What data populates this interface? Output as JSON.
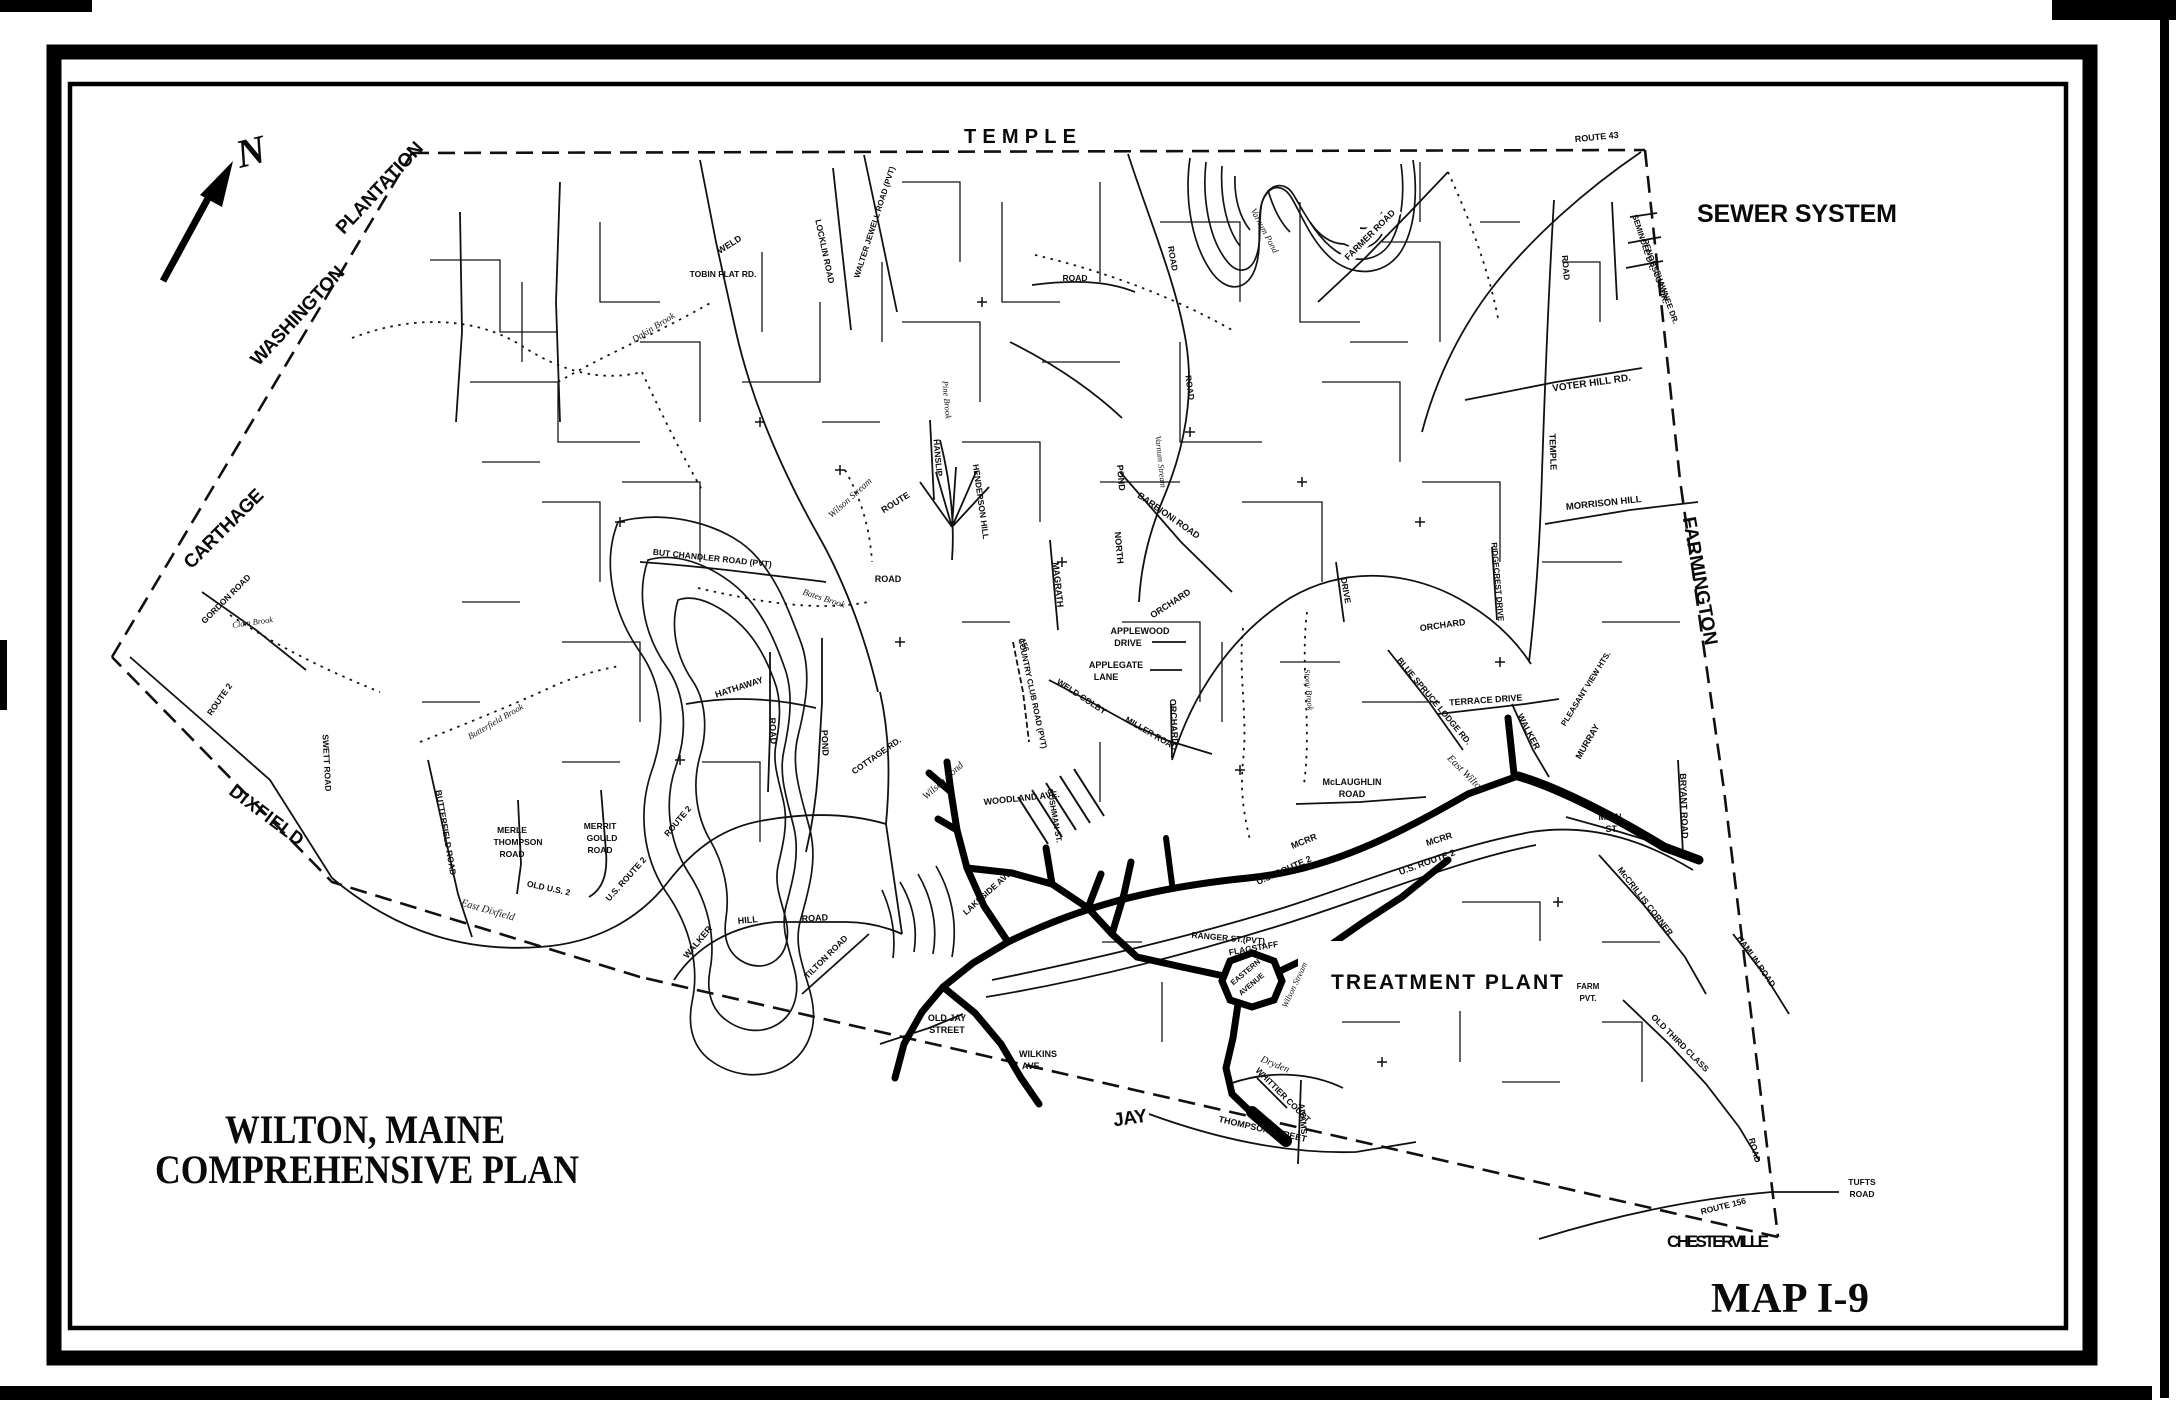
{
  "titles": {
    "region": "SEWER SYSTEM",
    "map_number": "MAP I-9",
    "plan_line1": "WILTON, MAINE",
    "plan_line2": "COMPREHENSIVE PLAN",
    "treatment_plant": "TREATMENT PLANT",
    "north": "N"
  },
  "neighbor_towns": [
    {
      "label": "TEMPLE",
      "x": 1020,
      "y": 143,
      "rot": 0,
      "size": 20,
      "len": 112
    },
    {
      "label": "WASHINGTON",
      "x": 302,
      "y": 320,
      "rot": -47,
      "size": 19,
      "len": 128
    },
    {
      "label": "PLANTATION",
      "x": 384,
      "y": 192,
      "rot": -47,
      "size": 19,
      "len": 118
    },
    {
      "label": "CARTHAGE",
      "x": 228,
      "y": 533,
      "rot": -45,
      "size": 19,
      "len": 104
    },
    {
      "label": "DIXFIELD",
      "x": 263,
      "y": 820,
      "rot": 37,
      "size": 18,
      "len": 88
    },
    {
      "label": "FARMINGTON",
      "x": 1694,
      "y": 582,
      "rot": 80,
      "size": 19,
      "len": 130
    },
    {
      "label": "CHESTERVILLE",
      "x": 1718,
      "y": 1247,
      "rot": 0,
      "size": 17,
      "len": 102
    },
    {
      "label": "JAY",
      "x": 1131,
      "y": 1124,
      "rot": -8,
      "size": 19,
      "len": 34
    }
  ],
  "map_labels": [
    {
      "text": "ROUTE 43",
      "x": 1597,
      "y": 140,
      "rot": -6,
      "size": 9
    },
    {
      "text": "SEMINOLE DR.",
      "x": 1641,
      "y": 243,
      "rot": 72,
      "size": 8
    },
    {
      "text": "PENOBSCOT DR.",
      "x": 1653,
      "y": 272,
      "rot": 72,
      "size": 8
    },
    {
      "text": "SHAWNEE DR.",
      "x": 1664,
      "y": 298,
      "rot": 70,
      "size": 8
    },
    {
      "text": "VOTER HILL RD.",
      "x": 1592,
      "y": 386,
      "rot": -8,
      "size": 10
    },
    {
      "text": "TEMPLE",
      "x": 1550,
      "y": 452,
      "rot": 88,
      "size": 9
    },
    {
      "text": "ROAD",
      "x": 1563,
      "y": 268,
      "rot": 85,
      "size": 8.5
    },
    {
      "text": "MORRISON HILL",
      "x": 1604,
      "y": 506,
      "rot": -6,
      "size": 9.5
    },
    {
      "text": "FARMER ROAD",
      "x": 1372,
      "y": 237,
      "rot": -45,
      "size": 9,
      "bg": true
    },
    {
      "text": "WELD",
      "x": 731,
      "y": 247,
      "rot": -32,
      "size": 9
    },
    {
      "text": "TOBIN FLAT RD.",
      "x": 723,
      "y": 277,
      "rot": 0,
      "size": 8.5
    },
    {
      "text": "LOCKLIN ROAD",
      "x": 822,
      "y": 252,
      "rot": 78,
      "size": 8.5
    },
    {
      "text": "WALTER JEWELL ROAD (PVT)",
      "x": 877,
      "y": 223,
      "rot": -72,
      "size": 8
    },
    {
      "text": "Dakin Brook",
      "x": 655,
      "y": 330,
      "rot": -32,
      "size": 9.5,
      "style": "water"
    },
    {
      "text": "Wilson Stream",
      "x": 852,
      "y": 500,
      "rot": -42,
      "size": 9.5,
      "style": "water"
    },
    {
      "text": "ROUTE",
      "x": 897,
      "y": 505,
      "rot": -32,
      "size": 9
    },
    {
      "text": "ROAD",
      "x": 888,
      "y": 582,
      "rot": 0,
      "size": 9
    },
    {
      "text": "HANSLIP",
      "x": 935,
      "y": 458,
      "rot": 85,
      "size": 8.5
    },
    {
      "text": "HENDERSON HILL",
      "x": 978,
      "y": 502,
      "rot": 82,
      "size": 8.5
    },
    {
      "text": "MAGRATH",
      "x": 1055,
      "y": 585,
      "rot": 84,
      "size": 9
    },
    {
      "text": "POND",
      "x": 1118,
      "y": 478,
      "rot": 85,
      "size": 9
    },
    {
      "text": "NORTH",
      "x": 1116,
      "y": 548,
      "rot": 85,
      "size": 9
    },
    {
      "text": "Varnum Pond",
      "x": 1262,
      "y": 232,
      "rot": 62,
      "size": 9,
      "style": "water"
    },
    {
      "text": "Varnum Stream",
      "x": 1158,
      "y": 462,
      "rot": 84,
      "size": 8.5,
      "style": "water"
    },
    {
      "text": "BARBIONI ROAD",
      "x": 1167,
      "y": 518,
      "rot": 35,
      "size": 9
    },
    {
      "text": "ORCHARD",
      "x": 1172,
      "y": 606,
      "rot": -33,
      "size": 9
    },
    {
      "text": "ORCHARD",
      "x": 1443,
      "y": 628,
      "rot": -8,
      "size": 9
    },
    {
      "text": "ORCHARD",
      "x": 1171,
      "y": 722,
      "rot": 87,
      "size": 9
    },
    {
      "text": "APPLEWOOD",
      "x": 1140,
      "y": 634,
      "rot": 0,
      "size": 9
    },
    {
      "text": "DRIVE",
      "x": 1128,
      "y": 646,
      "rot": 0,
      "size": 9
    },
    {
      "text": "APPLEGATE",
      "x": 1116,
      "y": 668,
      "rot": 0,
      "size": 9
    },
    {
      "text": "LANE",
      "x": 1106,
      "y": 680,
      "rot": 0,
      "size": 9
    },
    {
      "text": "TERRACE DRIVE",
      "x": 1486,
      "y": 703,
      "rot": -4,
      "size": 9
    },
    {
      "text": "RIDGECREST DRIVE",
      "x": 1495,
      "y": 582,
      "rot": 85,
      "size": 8
    },
    {
      "text": "BLUE SPRUCE LODGE RD.",
      "x": 1432,
      "y": 703,
      "rot": 50,
      "size": 8.5
    },
    {
      "text": "East Wilton",
      "x": 1464,
      "y": 776,
      "rot": 45,
      "size": 10.5,
      "style": "water"
    },
    {
      "text": "WALKER",
      "x": 1526,
      "y": 733,
      "rot": 62,
      "size": 9
    },
    {
      "text": "MCRR",
      "x": 1440,
      "y": 842,
      "rot": -18,
      "size": 9
    },
    {
      "text": "MCRR",
      "x": 1305,
      "y": 844,
      "rot": -22,
      "size": 9
    },
    {
      "text": "U.S. ROUTE 2",
      "x": 1428,
      "y": 865,
      "rot": -20,
      "size": 9
    },
    {
      "text": "U.S. ROUTE 2",
      "x": 1285,
      "y": 873,
      "rot": -24,
      "size": 9
    },
    {
      "text": "McLAUGHLIN",
      "x": 1352,
      "y": 785,
      "rot": 0,
      "size": 9
    },
    {
      "text": "ROAD",
      "x": 1352,
      "y": 797,
      "rot": 0,
      "size": 9
    },
    {
      "text": "PLEASANT VIEW HTS.",
      "x": 1588,
      "y": 690,
      "rot": -58,
      "size": 8
    },
    {
      "text": "MURRAY",
      "x": 1590,
      "y": 743,
      "rot": -60,
      "size": 9
    },
    {
      "text": "Stony Brook",
      "x": 1306,
      "y": 690,
      "rot": 85,
      "size": 8.5,
      "style": "water"
    },
    {
      "text": "WOODLAND AVE.",
      "x": 1022,
      "y": 801,
      "rot": -6,
      "size": 9
    },
    {
      "text": "CUSHMAN ST.",
      "x": 1052,
      "y": 816,
      "rot": 80,
      "size": 8
    },
    {
      "text": "LAKESIDE AVE.",
      "x": 990,
      "y": 894,
      "rot": -42,
      "size": 8.5
    },
    {
      "text": "COTTAGE RD.",
      "x": 878,
      "y": 758,
      "rot": -35,
      "size": 8.5
    },
    {
      "text": "Wilson Pond",
      "x": 945,
      "y": 783,
      "rot": -42,
      "size": 10,
      "style": "water"
    },
    {
      "text": "POND",
      "x": 822,
      "y": 743,
      "rot": 87,
      "size": 9
    },
    {
      "text": "ROAD",
      "x": 770,
      "y": 731,
      "rot": 87,
      "size": 9
    },
    {
      "text": "HATHAWAY",
      "x": 740,
      "y": 690,
      "rot": -18,
      "size": 9
    },
    {
      "text": "Bates Brook",
      "x": 823,
      "y": 601,
      "rot": 18,
      "size": 9,
      "style": "water"
    },
    {
      "text": "COUNTRY CLUB ROAD (PVT)",
      "x": 1030,
      "y": 694,
      "rot": 78,
      "size": 8
    },
    {
      "text": "156",
      "x": 1022,
      "y": 646,
      "rot": 70,
      "size": 8
    },
    {
      "text": "WELD COLBY",
      "x": 1080,
      "y": 699,
      "rot": 33,
      "size": 8.5
    },
    {
      "text": "MILLER ROAD",
      "x": 1150,
      "y": 736,
      "rot": 30,
      "size": 8.5
    },
    {
      "text": "RANGER ST.(PVT)",
      "x": 1228,
      "y": 941,
      "rot": 5,
      "size": 8.5
    },
    {
      "text": "FLAGSTAFF",
      "x": 1254,
      "y": 951,
      "rot": -10,
      "size": 8.5
    },
    {
      "text": "EASTERN",
      "x": 1247,
      "y": 974,
      "rot": -40,
      "size": 7.5
    },
    {
      "text": "AVENUE",
      "x": 1253,
      "y": 986,
      "rot": -40,
      "size": 7.5
    },
    {
      "text": "Wilson Stream",
      "x": 1297,
      "y": 986,
      "rot": -65,
      "size": 8.5,
      "style": "water"
    },
    {
      "text": "OLD JAY",
      "x": 947,
      "y": 1021,
      "rot": 0,
      "size": 9
    },
    {
      "text": "STREET",
      "x": 947,
      "y": 1033,
      "rot": 0,
      "size": 9
    },
    {
      "text": "WILKINS",
      "x": 1038,
      "y": 1057,
      "rot": 0,
      "size": 9
    },
    {
      "text": "AVE.",
      "x": 1032,
      "y": 1069,
      "rot": 0,
      "size": 9
    },
    {
      "text": "THOMPSON STREET",
      "x": 1262,
      "y": 1132,
      "rot": 13,
      "size": 9
    },
    {
      "text": "WHITTIER COURT",
      "x": 1281,
      "y": 1097,
      "rot": 45,
      "size": 8.5
    },
    {
      "text": "Dryden",
      "x": 1274,
      "y": 1067,
      "rot": 22,
      "size": 10,
      "style": "water"
    },
    {
      "text": "MAIN",
      "x": 1610,
      "y": 820,
      "rot": 0,
      "size": 9
    },
    {
      "text": "ST.",
      "x": 1612,
      "y": 832,
      "rot": 0,
      "size": 9
    },
    {
      "text": "BRYANT ROAD",
      "x": 1681,
      "y": 806,
      "rot": 88,
      "size": 9
    },
    {
      "text": "McCRILLIS CORNER",
      "x": 1643,
      "y": 903,
      "rot": 52,
      "size": 8.5
    },
    {
      "text": "HAMLIN ROAD",
      "x": 1754,
      "y": 963,
      "rot": 55,
      "size": 8.5
    },
    {
      "text": "FARM",
      "x": 1588,
      "y": 989,
      "rot": 0,
      "size": 8
    },
    {
      "text": "PVT.",
      "x": 1588,
      "y": 1001,
      "rot": 0,
      "size": 8
    },
    {
      "text": "OLD THIRD CLASS",
      "x": 1678,
      "y": 1045,
      "rot": 45,
      "size": 8.5
    },
    {
      "text": "ROAD",
      "x": 1752,
      "y": 1151,
      "rot": 75,
      "size": 8.5
    },
    {
      "text": "ROUTE 156",
      "x": 1724,
      "y": 1209,
      "rot": -14,
      "size": 8.5
    },
    {
      "text": "TUFTS",
      "x": 1862,
      "y": 1185,
      "rot": 0,
      "size": 8.5
    },
    {
      "text": "ROAD",
      "x": 1862,
      "y": 1197,
      "rot": 0,
      "size": 8.5
    },
    {
      "text": "MERLE",
      "x": 512,
      "y": 833,
      "rot": 0,
      "size": 8.5
    },
    {
      "text": "THOMPSON",
      "x": 518,
      "y": 845,
      "rot": 0,
      "size": 8.5
    },
    {
      "text": "ROAD",
      "x": 512,
      "y": 857,
      "rot": 0,
      "size": 8.5
    },
    {
      "text": "MERRIT",
      "x": 600,
      "y": 829,
      "rot": 0,
      "size": 8.5
    },
    {
      "text": "GOULD",
      "x": 602,
      "y": 841,
      "rot": 0,
      "size": 8.5
    },
    {
      "text": "ROAD",
      "x": 600,
      "y": 853,
      "rot": 0,
      "size": 8.5
    },
    {
      "text": "OLD U.S. 2",
      "x": 548,
      "y": 891,
      "rot": 12,
      "size": 8.5
    },
    {
      "text": "East Dixfield",
      "x": 487,
      "y": 913,
      "rot": 16,
      "size": 10.5,
      "style": "water"
    },
    {
      "text": "BUTTERFIELD ROAD",
      "x": 443,
      "y": 833,
      "rot": 80,
      "size": 8.5
    },
    {
      "text": "Butterfield Brook",
      "x": 497,
      "y": 724,
      "rot": -30,
      "size": 9,
      "style": "water"
    },
    {
      "text": "GORDON ROAD",
      "x": 228,
      "y": 601,
      "rot": -45,
      "size": 8.5
    },
    {
      "text": "Clam Brook",
      "x": 253,
      "y": 625,
      "rot": -8,
      "size": 8.5,
      "style": "water"
    },
    {
      "text": "SWETT ROAD",
      "x": 324,
      "y": 763,
      "rot": 87,
      "size": 8.5
    },
    {
      "text": "WALKER",
      "x": 700,
      "y": 944,
      "rot": -50,
      "size": 9
    },
    {
      "text": "HILL",
      "x": 748,
      "y": 923,
      "rot": -5,
      "size": 9
    },
    {
      "text": "ROAD",
      "x": 815,
      "y": 921,
      "rot": -3,
      "size": 9
    },
    {
      "text": "TILTON ROAD",
      "x": 828,
      "y": 959,
      "rot": -45,
      "size": 8.5
    },
    {
      "text": "BUT CHANDLER ROAD (PVT)",
      "x": 712,
      "y": 561,
      "rot": 6,
      "size": 8.5
    },
    {
      "text": "ROAD",
      "x": 1075,
      "y": 281,
      "rot": 0,
      "size": 8.5
    },
    {
      "text": "ROAD",
      "x": 1170,
      "y": 259,
      "rot": 80,
      "size": 8.5
    },
    {
      "text": "ROAD",
      "x": 1187,
      "y": 388,
      "rot": 82,
      "size": 8.5
    },
    {
      "text": "Pine Brook",
      "x": 944,
      "y": 400,
      "rot": 85,
      "size": 8.5,
      "style": "water"
    },
    {
      "text": "ROUTE 2",
      "x": 222,
      "y": 701,
      "rot": -55,
      "size": 8.5
    },
    {
      "text": "U.S. ROUTE 2",
      "x": 628,
      "y": 881,
      "rot": -48,
      "size": 8.5
    },
    {
      "text": "ROUTE 2",
      "x": 680,
      "y": 823,
      "rot": -50,
      "size": 8.5
    },
    {
      "text": "ADAMS",
      "x": 1300,
      "y": 1119,
      "rot": 85,
      "size": 8.5
    },
    {
      "text": "DRIVE",
      "x": 1343,
      "y": 591,
      "rot": 80,
      "size": 8.5
    }
  ]
}
